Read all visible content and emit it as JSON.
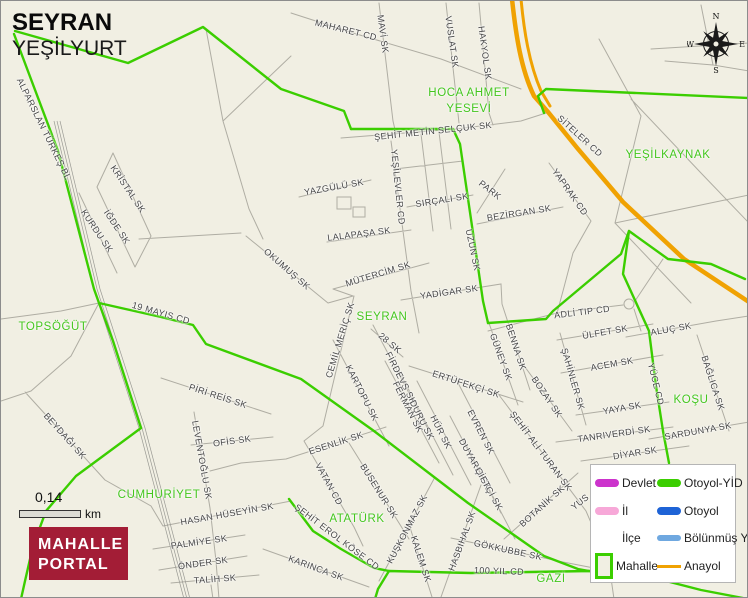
{
  "title": {
    "primary": "SEYRAN",
    "secondary": "YEŞİLYURT"
  },
  "compass": {
    "n": "N",
    "e": "E",
    "s": "S",
    "w": "W"
  },
  "scale_bar": {
    "value": "0,14",
    "unit": "km"
  },
  "logo": {
    "line1": "MAHALLE",
    "line2": "PORTAL"
  },
  "colors": {
    "background": "#F1EFE3",
    "road_gray": "#A9A79D",
    "boundary_green": "#3BCE00",
    "anayol_orange": "#F0A202",
    "area_label_green": "#44C61E",
    "street_label_gray": "#454545",
    "logo_red": "#A31D36",
    "devlet_magenta": "#CC33CC",
    "il_pink": "#F7A8D8",
    "otoyol_blue": "#1E63D6",
    "bolunmus_light_blue": "#6FA8E0"
  },
  "area_labels": [
    {
      "t": "HOCA AHMET",
      "x": 468,
      "y": 92
    },
    {
      "t": "YESEVİ",
      "x": 468,
      "y": 108
    },
    {
      "t": "YEŞİLKAYNAK",
      "x": 667,
      "y": 154
    },
    {
      "t": "TOPSÖĞÜT",
      "x": 52,
      "y": 326
    },
    {
      "t": "SEYRAN",
      "x": 381,
      "y": 316
    },
    {
      "t": "KOŞU",
      "x": 690,
      "y": 399
    },
    {
      "t": "CUMHURİYET",
      "x": 158,
      "y": 494
    },
    {
      "t": "ATATÜRK",
      "x": 356,
      "y": 518
    },
    {
      "t": "GAZİ",
      "x": 550,
      "y": 578
    }
  ],
  "street_labels": [
    {
      "t": "MAHARET CD",
      "x": 345,
      "y": 29,
      "r": 14
    },
    {
      "t": "MAVİ SK",
      "x": 382,
      "y": 33,
      "r": 82
    },
    {
      "t": "VUSLAT SK",
      "x": 451,
      "y": 41,
      "r": 82
    },
    {
      "t": "HAKYOL SK",
      "x": 484,
      "y": 52,
      "r": 82
    },
    {
      "t": "SİTELER CD",
      "x": 579,
      "y": 135,
      "r": 42
    },
    {
      "t": "ŞEHİT METİN SELÇUK SK",
      "x": 432,
      "y": 130,
      "r": -6
    },
    {
      "t": "YEŞİLEVLER CD",
      "x": 397,
      "y": 186,
      "r": 84
    },
    {
      "t": "YAZGÜLÜ SK",
      "x": 333,
      "y": 186,
      "r": -10
    },
    {
      "t": "SIRÇALI SK",
      "x": 441,
      "y": 199,
      "r": -9
    },
    {
      "t": "PARK",
      "x": 489,
      "y": 189,
      "r": 38
    },
    {
      "t": "BEZİRGAN SK",
      "x": 518,
      "y": 212,
      "r": -9
    },
    {
      "t": "YAPRAK CD",
      "x": 569,
      "y": 191,
      "r": 55
    },
    {
      "t": "ALPARSLAN TÜRKEŞ BL",
      "x": 43,
      "y": 128,
      "r": 64
    },
    {
      "t": "KRİSTAL SK",
      "x": 127,
      "y": 188,
      "r": 56
    },
    {
      "t": "İĞDE SK",
      "x": 116,
      "y": 226,
      "r": 56
    },
    {
      "t": "KURDU SK",
      "x": 96,
      "y": 230,
      "r": 56
    },
    {
      "t": "LALAPAŞA SK",
      "x": 358,
      "y": 233,
      "r": -7
    },
    {
      "t": "OKUMUŞ SK",
      "x": 286,
      "y": 268,
      "r": 41
    },
    {
      "t": "MÜTERCİM SK",
      "x": 377,
      "y": 273,
      "r": -17
    },
    {
      "t": "UZUN SK",
      "x": 472,
      "y": 249,
      "r": 78
    },
    {
      "t": "YADİGAR SK",
      "x": 448,
      "y": 291,
      "r": -8
    },
    {
      "t": "19 MAYIS CD",
      "x": 160,
      "y": 312,
      "r": 16
    },
    {
      "t": "ADLİ TIP CD",
      "x": 581,
      "y": 311,
      "r": -7
    },
    {
      "t": "ÜLFET SK",
      "x": 604,
      "y": 331,
      "r": -10
    },
    {
      "t": "ALUÇ SK",
      "x": 670,
      "y": 328,
      "r": -10
    },
    {
      "t": "CEMİL MERİÇ SK",
      "x": 339,
      "y": 339,
      "r": -73
    },
    {
      "t": "28 SK",
      "x": 389,
      "y": 342,
      "r": 40
    },
    {
      "t": "BENNA SK",
      "x": 515,
      "y": 346,
      "r": 72
    },
    {
      "t": "GÜNEY SK",
      "x": 500,
      "y": 356,
      "r": 70
    },
    {
      "t": "ŞAHİNLER SK",
      "x": 572,
      "y": 378,
      "r": 74
    },
    {
      "t": "ACEM SK",
      "x": 611,
      "y": 363,
      "r": -10
    },
    {
      "t": "BOZAY SK",
      "x": 546,
      "y": 396,
      "r": 56
    },
    {
      "t": "KARTOPU SK",
      "x": 361,
      "y": 392,
      "r": 63
    },
    {
      "t": "FİRDEVS SK",
      "x": 400,
      "y": 377,
      "r": 63
    },
    {
      "t": "ERTÜFEKÇİ SK",
      "x": 465,
      "y": 383,
      "r": 18
    },
    {
      "t": "YÜCE CD",
      "x": 655,
      "y": 383,
      "r": 76
    },
    {
      "t": "BAĞLICA SK",
      "x": 712,
      "y": 382,
      "r": 72
    },
    {
      "t": "PİRİ REİS SK",
      "x": 217,
      "y": 395,
      "r": 18
    },
    {
      "t": "YAYA SK",
      "x": 621,
      "y": 407,
      "r": -10
    },
    {
      "t": "FERMAN SK",
      "x": 407,
      "y": 406,
      "r": 63
    },
    {
      "t": "DURU SK",
      "x": 421,
      "y": 419,
      "r": 63
    },
    {
      "t": "HÜR SK",
      "x": 440,
      "y": 431,
      "r": 63
    },
    {
      "t": "EVREN SK",
      "x": 480,
      "y": 431,
      "r": 63
    },
    {
      "t": "SARDUNYA SK",
      "x": 697,
      "y": 430,
      "r": -10
    },
    {
      "t": "TANRIVERDİ SK",
      "x": 613,
      "y": 433,
      "r": -8
    },
    {
      "t": "BEYDAĞI SK",
      "x": 64,
      "y": 435,
      "r": 48
    },
    {
      "t": "OFİS SK",
      "x": 231,
      "y": 440,
      "r": -8
    },
    {
      "t": "ESENLİK SK",
      "x": 335,
      "y": 442,
      "r": -18
    },
    {
      "t": "ŞEHİT ALİ TURAN SK",
      "x": 540,
      "y": 450,
      "r": 53
    },
    {
      "t": "DİYAR SK",
      "x": 634,
      "y": 452,
      "r": -9
    },
    {
      "t": "LEVENTOĞLU SK",
      "x": 201,
      "y": 459,
      "r": 80
    },
    {
      "t": "DUYARLI SK",
      "x": 474,
      "y": 463,
      "r": 61
    },
    {
      "t": "VATAN CD",
      "x": 328,
      "y": 483,
      "r": 61
    },
    {
      "t": "BUSENUR SK",
      "x": 378,
      "y": 490,
      "r": 58
    },
    {
      "t": "ÇİFTÇİ SK",
      "x": 488,
      "y": 488,
      "r": 61
    },
    {
      "t": "YUS",
      "x": 579,
      "y": 501,
      "r": -38
    },
    {
      "t": "BOTANİK SK",
      "x": 541,
      "y": 505,
      "r": -42
    },
    {
      "t": "HASAN HÜSEYİN SK",
      "x": 226,
      "y": 513,
      "r": -10
    },
    {
      "t": "KUŞKONMAZ SK",
      "x": 406,
      "y": 528,
      "r": -62
    },
    {
      "t": "ŞEHİT EROL KÖSE CD",
      "x": 336,
      "y": 536,
      "r": 37
    },
    {
      "t": "HASBIHAL SK",
      "x": 461,
      "y": 540,
      "r": -70
    },
    {
      "t": "PALMİYE SK",
      "x": 198,
      "y": 541,
      "r": -8
    },
    {
      "t": "GÖKKUBBE SK",
      "x": 507,
      "y": 549,
      "r": 12
    },
    {
      "t": "KALEM SK",
      "x": 420,
      "y": 558,
      "r": 72
    },
    {
      "t": "ÖNDER SK",
      "x": 202,
      "y": 562,
      "r": -8
    },
    {
      "t": "KARINCA SK",
      "x": 315,
      "y": 567,
      "r": 20
    },
    {
      "t": "100 YIL CD",
      "x": 498,
      "y": 570,
      "r": 2
    },
    {
      "t": "TALİH SK",
      "x": 214,
      "y": 578,
      "r": -4
    }
  ],
  "legend": {
    "left": [
      {
        "label": "Devlet",
        "swatch": "line-thick",
        "color": "#CC33CC"
      },
      {
        "label": "İl",
        "swatch": "line-thick",
        "color": "#F7A8D8"
      },
      {
        "label": "İlçe",
        "swatch": "line-thick",
        "color": "#FFFFFF"
      },
      {
        "label": "Mahalle",
        "swatch": "rect",
        "color": "#3BCE00"
      }
    ],
    "right": [
      {
        "label": "Otoyol-YİD",
        "swatch": "line-thick",
        "color": "#3BCE00"
      },
      {
        "label": "Otoyol",
        "swatch": "line-thick",
        "color": "#1E63D6"
      },
      {
        "label": "Bölünmüş Y",
        "swatch": "line-med",
        "color": "#6FA8E0"
      },
      {
        "label": "Anayol",
        "swatch": "line-thin",
        "color": "#F0A202"
      }
    ]
  }
}
